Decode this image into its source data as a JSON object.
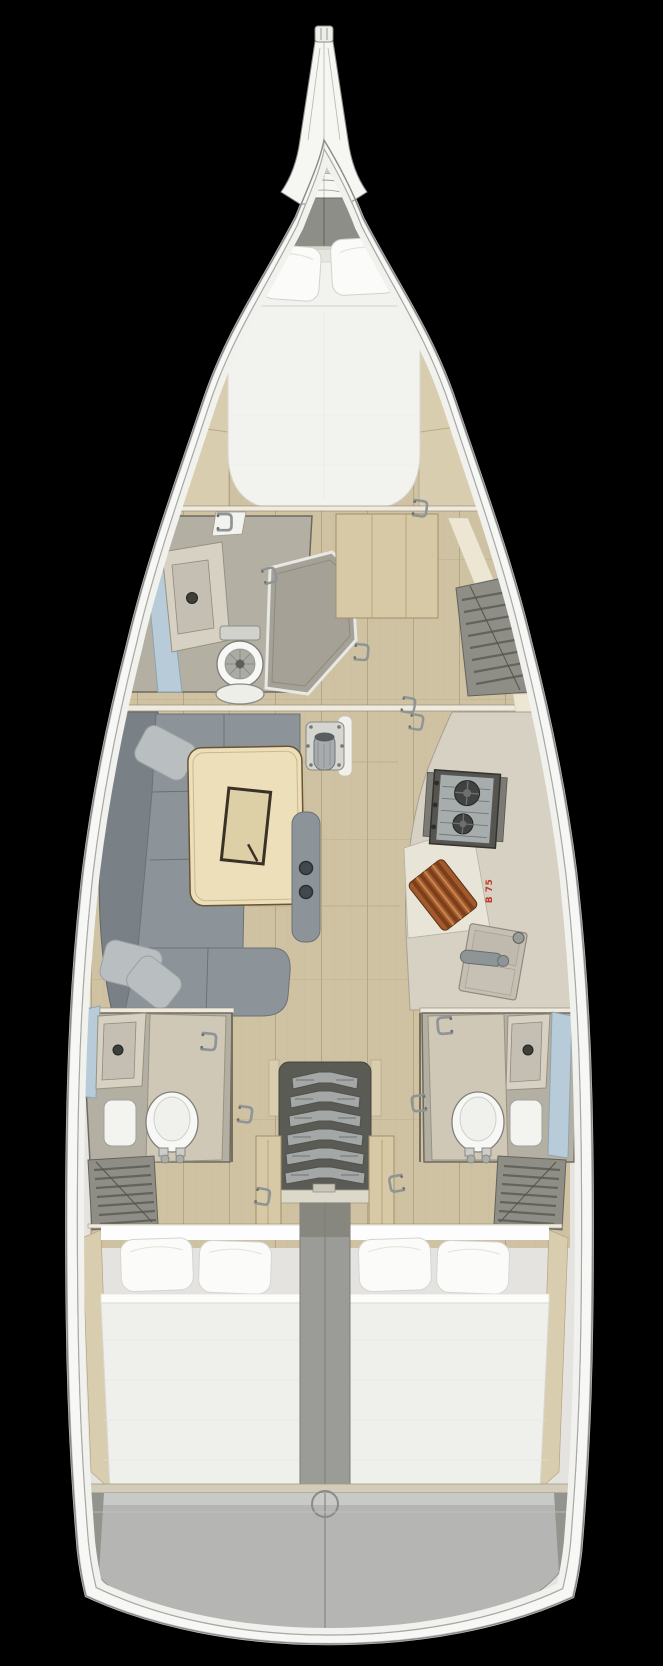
{
  "annotation": {
    "galley_label": "B 75"
  },
  "colors": {
    "bg": "#000000",
    "hull": "#f7f7f5",
    "deck": "#e4e3df",
    "wood": "#cfc2a2",
    "woodline": "#b4a583",
    "shelf": "#d9cdaf",
    "cream": "#ece6d3",
    "roomfloor": "#b4afa3",
    "counter": "#d6d1c3",
    "sink": "#c4bfb2",
    "sofa": "#8d9499",
    "sofadark": "#798187",
    "pillow": "#b9bec1",
    "table": "#ecdfba",
    "stove": "#55544e",
    "stovetop": "#a7adad",
    "burner": "#3f4240",
    "board": "#a05a2e",
    "label": "#c0392b",
    "stairs": "#a3a8a6",
    "stairdark": "#5a5b55",
    "divider": "#9b9b97",
    "bed": "#efefec",
    "bedpillow": "#fbfbfa",
    "window": "#b7cbd9",
    "louver": "#8e8d86",
    "locker": "#8e8e88",
    "stern": "#b5b5b3",
    "sterntop": "#c9c9c7",
    "metal": "#8f9496",
    "toilet": "#f7f7f5",
    "door": "#cfc8b6",
    "wardrobe": "#d8c9a6",
    "wall": "#efeadd"
  }
}
